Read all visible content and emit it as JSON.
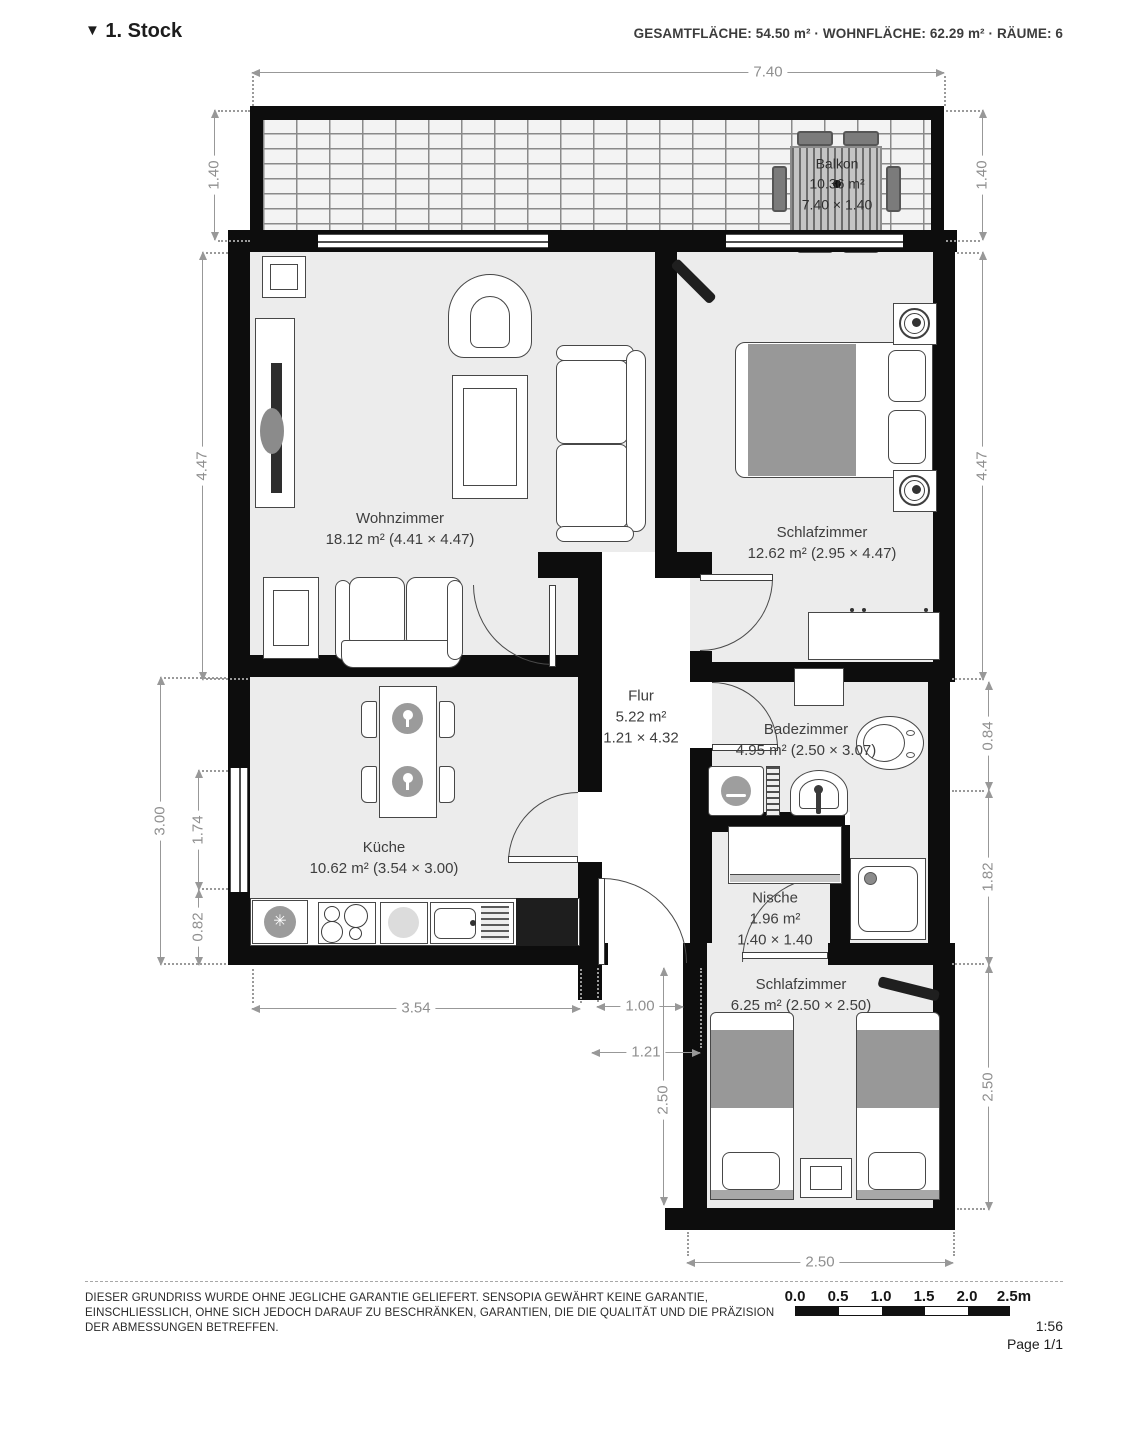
{
  "header": {
    "collapse_icon": "▼",
    "floor_label": "1. Stock",
    "stats": "GESAMTFLÄCHE: 54.50 m² · WOHNFLÄCHE: 62.29 m² · RÄUME: 6"
  },
  "rooms": {
    "balkon": {
      "name": "Balkon",
      "area": "10.36 m²",
      "size": "7.40 × 1.40"
    },
    "wohnzimmer": {
      "name": "Wohnzimmer",
      "size": "18.12 m² (4.41 × 4.47)"
    },
    "schlafzimmer1": {
      "name": "Schlafzimmer",
      "size": "12.62 m² (2.95 × 4.47)"
    },
    "flur": {
      "name": "Flur",
      "area": "5.22 m²",
      "size": "1.21 × 4.32"
    },
    "badezimmer": {
      "name": "Badezimmer",
      "size": "4.95 m² (2.50 × 3.07)"
    },
    "kueche": {
      "name": "Küche",
      "size": "10.62 m² (3.54 × 3.00)"
    },
    "nische": {
      "name": "Nische",
      "area": "1.96 m²",
      "size": "1.40 × 1.40"
    },
    "schlafzimmer2": {
      "name": "Schlafzimmer",
      "size": "6.25 m² (2.50 × 2.50)"
    }
  },
  "dims": {
    "total_width": "7.40",
    "balcony_left": "1.40",
    "balcony_right": "1.40",
    "living_left": "4.47",
    "bedroom_right": "4.47",
    "kitchen_left": "3.00",
    "kitchen_window": "1.74",
    "kitchen_lower": "0.82",
    "bath_right": "0.84",
    "shower_right": "1.82",
    "bedroom2_right": "2.50",
    "kitchen_bottom": "3.54",
    "entry_width": "1.00",
    "hall_width": "1.21",
    "bedroom2_height": "2.50",
    "bedroom2_width": "2.50"
  },
  "icons": {
    "snowflake": "✳"
  },
  "footer": {
    "disclaimer_line1": "DIESER GRUNDRISS WURDE OHNE JEGLICHE GARANTIE GELIEFERT. SENSOPIA GEWÄHRT KEINE GARANTIE,",
    "disclaimer_line2": "EINSCHLIESSLICH, OHNE SICH JEDOCH DARAUF ZU BESCHRÄNKEN, GARANTIEN, DIE DIE QUALITÄT UND DIE PRÄZISION",
    "disclaimer_line3": "DER ABMESSUNGEN BETREFFEN.",
    "scale_ticks": [
      "0.0",
      "0.5",
      "1.0",
      "1.5",
      "2.0",
      "2.5m"
    ],
    "scale_ratio": "1:56",
    "page": "Page 1/1"
  },
  "colors": {
    "wall": "#0d0d0d",
    "room_fill": "#ececec",
    "hall_fill": "#ffffff",
    "dim": "#8f8f8f",
    "blanket": "#989898"
  }
}
